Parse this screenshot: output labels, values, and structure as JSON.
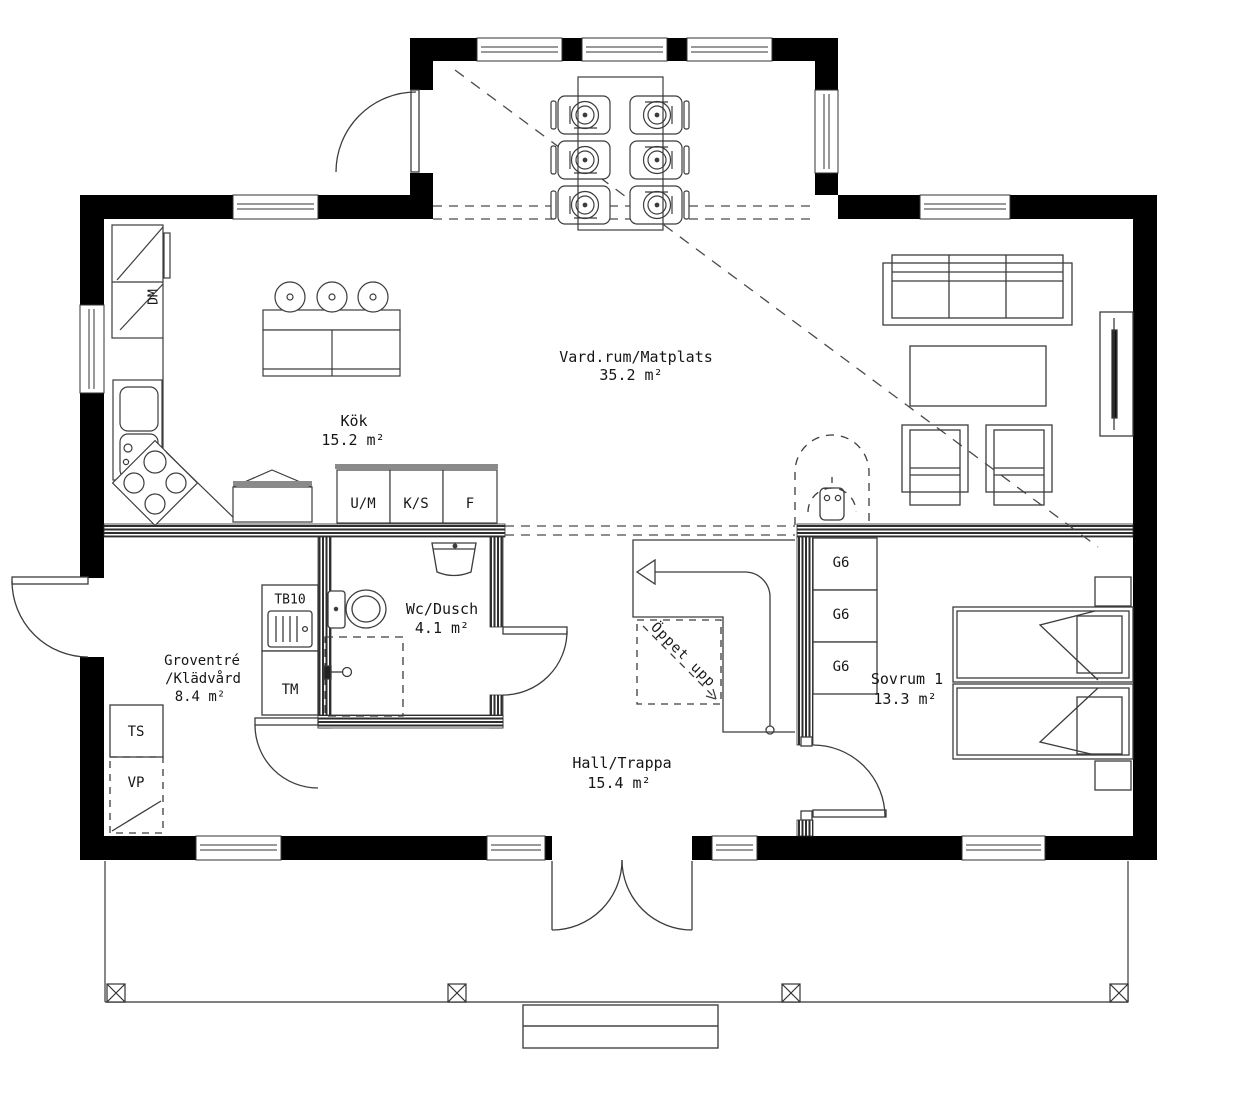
{
  "plan": {
    "rooms": {
      "living": {
        "name": "Vard.rum/Matplats",
        "area": "35.2 m²"
      },
      "kitchen": {
        "name": "Kök",
        "area": "15.2 m²"
      },
      "utility": {
        "name1": "Groventré",
        "name2": "/Klädvård",
        "area": "8.4 m²"
      },
      "wc": {
        "name": "Wc/Dusch",
        "area": "4.1 m²"
      },
      "hall": {
        "name": "Hall/Trappa",
        "area": "15.4 m²"
      },
      "bedroom": {
        "name": "Sovrum 1",
        "area": "13.3 m²"
      }
    },
    "fixtures": {
      "dm": "DM",
      "um": "U/M",
      "ks": "K/S",
      "f": "F",
      "tb10": "TB10",
      "tm": "TM",
      "ts": "TS",
      "vp": "VP",
      "g6": [
        "G6",
        "G6",
        "G6"
      ],
      "stairs_note": "Öppet upp"
    },
    "colors": {
      "wall": "#000000",
      "interior_wall": "#2e2e2e",
      "line": "#3c3c3c",
      "dash": "#4a4a4a",
      "background": "#ffffff"
    }
  }
}
